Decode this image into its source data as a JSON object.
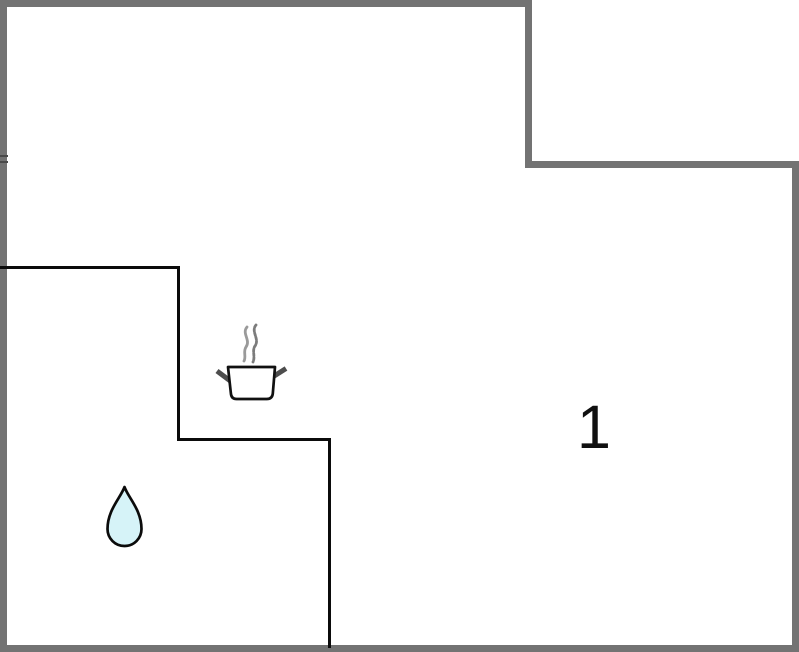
{
  "floorplan": {
    "room_label": "1",
    "icons": [
      {
        "name": "cooking-pot-icon"
      },
      {
        "name": "water-drop-icon"
      }
    ],
    "colors": {
      "outer_wall": "#737373",
      "inner_wall": "#0b0b0b",
      "pot_body_fill": "#ffffff",
      "pot_outline": "#111111",
      "pot_handle": "#4d4d4d",
      "steam_left": "#9a9a9a",
      "steam_right": "#7c7c7c",
      "drop_fill": "#d6f3f8",
      "drop_stroke": "#0b0b0b",
      "label_color": "#101010",
      "background": "#ffffff"
    }
  }
}
